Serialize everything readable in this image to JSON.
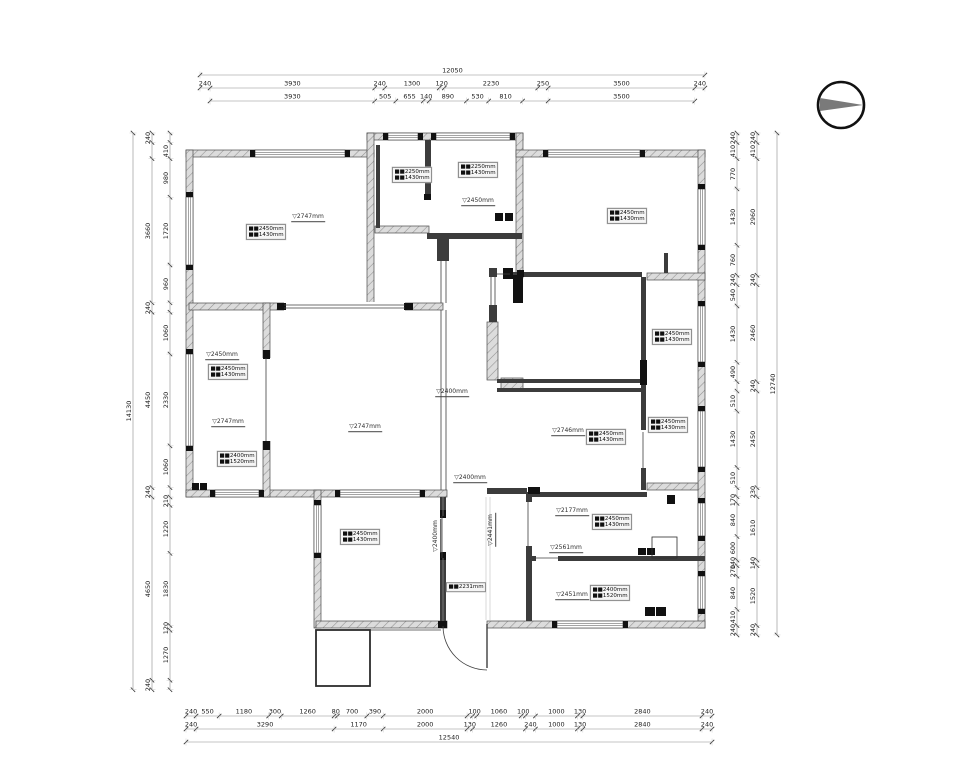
{
  "document": {
    "type": "residential floor plan with dimension chains",
    "north_arrow": "compass-right-pointing"
  },
  "compass": {
    "cx": 841,
    "cy": 105,
    "r": 23,
    "needle_color": "#7a7a7a",
    "ring_color": "#111111"
  },
  "colors": {
    "wall_hatch": "#dcdcdc",
    "wall_stroke": "#4a4a4a",
    "new_wall": "#3c3c3c",
    "dim_line": "#8c8c8c",
    "dim_text": "#222222"
  },
  "dims": [
    {
      "o": "h",
      "x": 200,
      "y": 75,
      "s": 0.0419,
      "segs": [
        {
          "v": 12050
        }
      ]
    },
    {
      "o": "h",
      "x": 200,
      "y": 88,
      "s": 0.0419,
      "segs": [
        240,
        3930,
        240,
        1300,
        120,
        2230,
        250,
        3500,
        240
      ]
    },
    {
      "o": "h",
      "x": 210,
      "y": 101,
      "s": 0.0419,
      "segs": [
        3930,
        505,
        655,
        140,
        890,
        530,
        810,
        {
          "v": 610,
          "l": ""
        },
        3500
      ]
    },
    {
      "o": "v",
      "x": 133,
      "y": 133,
      "s": 0.0394,
      "segs": [
        {
          "v": 14130
        }
      ]
    },
    {
      "o": "v",
      "x": 152,
      "y": 133,
      "s": 0.0394,
      "segs": [
        240,
        {
          "v": 410,
          "l": ""
        },
        3660,
        240,
        4450,
        240,
        4650,
        240
      ]
    },
    {
      "o": "v",
      "x": 170,
      "y": 133,
      "s": 0.0394,
      "segs": [
        {
          "v": 240,
          "l": ""
        },
        410,
        980,
        1720,
        960,
        {
          "v": 240,
          "l": ""
        },
        1060,
        2330,
        1060,
        {
          "v": 240,
          "l": ""
        },
        210,
        1220,
        1830,
        120,
        1270,
        {
          "v": 240,
          "l": ""
        }
      ]
    },
    {
      "o": "v",
      "x": 777,
      "y": 133,
      "s": 0.0394,
      "segs": [
        {
          "v": 12740
        }
      ]
    },
    {
      "o": "v",
      "x": 757,
      "y": 133,
      "s": 0.0394,
      "segs": [
        240,
        410,
        2960,
        240,
        2460,
        240,
        2450,
        230,
        1610,
        140,
        1520,
        240
      ]
    },
    {
      "o": "v",
      "x": 737,
      "y": 133,
      "s": 0.0394,
      "segs": [
        240,
        410,
        770,
        1430,
        760,
        240,
        540,
        1430,
        490,
        {
          "v": 240,
          "l": ""
        },
        510,
        1430,
        510,
        {
          "v": 230,
          "l": ""
        },
        170,
        840,
        600,
        140,
        270,
        840,
        410,
        240
      ]
    },
    {
      "o": "h",
      "x": 186,
      "y": 716,
      "s": 0.04195,
      "segs": [
        240,
        550,
        1180,
        300,
        1260,
        80,
        700,
        390,
        2000,
        {
          "v": 130,
          "l": ""
        },
        100,
        1060,
        100,
        {
          "v": 240,
          "l": ""
        },
        1000,
        130,
        2840,
        240
      ]
    },
    {
      "o": "h",
      "x": 186,
      "y": 729,
      "s": 0.04195,
      "segs": [
        240,
        3290,
        1170,
        2000,
        130,
        1260,
        240,
        1000,
        130,
        2840,
        240
      ]
    },
    {
      "o": "h",
      "x": 186,
      "y": 742,
      "s": 0.04195,
      "segs": [
        {
          "v": 12540
        }
      ]
    }
  ],
  "tags2": [
    {
      "x": 266,
      "y": 232,
      "l1": "■■2450mm",
      "l2": "■■1430mm"
    },
    {
      "x": 412,
      "y": 175,
      "l1": "■■2250mm",
      "l2": "■■1430mm"
    },
    {
      "x": 478,
      "y": 170,
      "l1": "■■2250mm",
      "l2": "■■1430mm"
    },
    {
      "x": 627,
      "y": 216,
      "l1": "■■2450mm",
      "l2": "■■1430mm"
    },
    {
      "x": 228,
      "y": 372,
      "l1": "■■2450mm",
      "l2": "■■1430mm"
    },
    {
      "x": 237,
      "y": 459,
      "l1": "■■2400mm",
      "l2": "■■1520mm"
    },
    {
      "x": 672,
      "y": 337,
      "l1": "■■2450mm",
      "l2": "■■1430mm"
    },
    {
      "x": 668,
      "y": 425,
      "l1": "■■2450mm",
      "l2": "■■1430mm"
    },
    {
      "x": 606,
      "y": 437,
      "l1": "■■2450mm",
      "l2": "■■1430mm"
    },
    {
      "x": 360,
      "y": 537,
      "l1": "■■2450mm",
      "l2": "■■1430mm"
    },
    {
      "x": 612,
      "y": 522,
      "l1": "■■2450mm",
      "l2": "■■1430mm"
    },
    {
      "x": 610,
      "y": 593,
      "l1": "■■2400mm",
      "l2": "■■1520mm"
    }
  ],
  "tags1": [
    {
      "x": 466,
      "y": 587,
      "t": "■■2231mm"
    }
  ],
  "levels": [
    {
      "x": 308,
      "y": 218,
      "t": "▽2747mm"
    },
    {
      "x": 478,
      "y": 202,
      "t": "▽2450mm"
    },
    {
      "x": 222,
      "y": 356,
      "t": "▽2450mm"
    },
    {
      "x": 228,
      "y": 423,
      "t": "▽2747mm"
    },
    {
      "x": 365,
      "y": 428,
      "t": "▽2747mm"
    },
    {
      "x": 568,
      "y": 432,
      "t": "▽2746mm"
    },
    {
      "x": 452,
      "y": 393,
      "t": "▽2400mm"
    },
    {
      "x": 470,
      "y": 479,
      "t": "▽2400mm"
    },
    {
      "x": 437,
      "y": 536,
      "t": "▽2400mm",
      "r": 1
    },
    {
      "x": 492,
      "y": 530,
      "t": "▽2441mm",
      "r": 1
    },
    {
      "x": 572,
      "y": 512,
      "t": "▽2177mm"
    },
    {
      "x": 566,
      "y": 549,
      "t": "▽2561mm"
    },
    {
      "x": 572,
      "y": 596,
      "t": "▽2451mm"
    }
  ],
  "plan": {
    "walls": [
      [
        186,
        150,
        188,
        7
      ],
      [
        367,
        133,
        156,
        7
      ],
      [
        516,
        133,
        7,
        145
      ],
      [
        367,
        133,
        7,
        170
      ],
      [
        516,
        150,
        189,
        7
      ],
      [
        698,
        150,
        7,
        478
      ],
      [
        186,
        150,
        7,
        347
      ],
      [
        186,
        490,
        261,
        7
      ],
      [
        314,
        490,
        7,
        138
      ],
      [
        316,
        621,
        131,
        7
      ],
      [
        487,
        621,
        218,
        7
      ],
      [
        189,
        303,
        254,
        7
      ],
      [
        263,
        303,
        7,
        194
      ],
      [
        375,
        226,
        54,
        7
      ],
      [
        647,
        273,
        58,
        7
      ],
      [
        647,
        483,
        51,
        7
      ],
      [
        487,
        322,
        11,
        58
      ],
      [
        501,
        378,
        22,
        13
      ]
    ],
    "nwalls": [
      [
        425,
        140,
        6,
        60
      ],
      [
        427,
        233,
        95,
        6
      ],
      [
        437,
        239,
        12,
        22
      ],
      [
        376,
        145,
        4,
        83
      ],
      [
        510,
        272,
        132,
        5
      ],
      [
        641,
        277,
        5,
        153
      ],
      [
        641,
        468,
        5,
        22
      ],
      [
        497,
        379,
        145,
        4
      ],
      [
        497,
        388,
        145,
        4
      ],
      [
        526,
        492,
        6,
        10
      ],
      [
        526,
        546,
        6,
        75
      ],
      [
        530,
        492,
        117,
        5
      ],
      [
        526,
        556,
        10,
        5
      ],
      [
        558,
        556,
        147,
        5
      ],
      [
        440,
        497,
        6,
        19
      ],
      [
        440,
        558,
        6,
        63
      ],
      [
        487,
        488,
        40,
        6
      ],
      [
        489,
        268,
        8,
        9
      ],
      [
        489,
        305,
        8,
        17
      ],
      [
        664,
        253,
        4,
        20
      ]
    ],
    "gaps": [
      [
        262,
        358,
        9,
        83
      ],
      [
        284,
        302,
        121,
        9
      ]
    ],
    "windows": [
      [
        255,
        150,
        90,
        "h"
      ],
      [
        388,
        133,
        30,
        "h"
      ],
      [
        436,
        133,
        74,
        "h"
      ],
      [
        548,
        150,
        92,
        "h"
      ],
      [
        698,
        189,
        56,
        "v"
      ],
      [
        698,
        306,
        56,
        "v"
      ],
      [
        698,
        411,
        56,
        "v"
      ],
      [
        698,
        503,
        33,
        "v"
      ],
      [
        698,
        576,
        33,
        "v"
      ],
      [
        557,
        621,
        66,
        "h"
      ],
      [
        186,
        197,
        68,
        "v"
      ],
      [
        186,
        354,
        92,
        "v"
      ],
      [
        215,
        490,
        44,
        "h"
      ],
      [
        340,
        490,
        80,
        "h"
      ],
      [
        314,
        505,
        48,
        "v"
      ]
    ],
    "solids": [
      [
        503,
        268,
        10,
        11
      ],
      [
        513,
        275,
        10,
        28
      ],
      [
        640,
        360,
        7,
        25
      ],
      [
        495,
        213,
        8,
        8
      ],
      [
        505,
        213,
        8,
        8
      ],
      [
        638,
        548,
        8,
        7
      ],
      [
        647,
        548,
        8,
        7
      ],
      [
        645,
        607,
        10,
        9
      ],
      [
        656,
        607,
        10,
        9
      ],
      [
        192,
        483,
        7,
        7
      ],
      [
        200,
        483,
        7,
        7
      ],
      [
        438,
        621,
        9,
        7
      ],
      [
        440,
        510,
        6,
        8
      ],
      [
        440,
        552,
        6,
        8
      ],
      [
        263,
        350,
        7,
        9
      ],
      [
        263,
        441,
        7,
        9
      ],
      [
        277,
        303,
        9,
        7
      ],
      [
        404,
        303,
        9,
        7
      ],
      [
        517,
        270,
        7,
        7
      ],
      [
        528,
        487,
        12,
        7
      ],
      [
        424,
        194,
        7,
        6
      ],
      [
        667,
        495,
        8,
        9
      ]
    ],
    "lines": [
      [
        266,
        358,
        266,
        441
      ],
      [
        284,
        305,
        405,
        305
      ],
      [
        284,
        308,
        405,
        308
      ],
      [
        441,
        261,
        441,
        303
      ],
      [
        446,
        261,
        446,
        303
      ],
      [
        441,
        310,
        441,
        490
      ],
      [
        446,
        310,
        446,
        490
      ],
      [
        442,
        516,
        442,
        558
      ],
      [
        497,
        274,
        510,
        274
      ],
      [
        536,
        558,
        558,
        558
      ],
      [
        528,
        502,
        528,
        546
      ],
      [
        491,
        277,
        491,
        305
      ],
      [
        495,
        277,
        495,
        305
      ],
      [
        643,
        432,
        643,
        468
      ],
      [
        370,
        630,
        441,
        630
      ],
      [
        487,
        624,
        487,
        668,
        1.4
      ]
    ],
    "lite": [
      [
        486,
        497,
        486,
        620
      ],
      [
        490,
        497,
        490,
        620
      ],
      [
        443,
        497,
        443,
        516
      ],
      [
        443,
        558,
        443,
        621
      ]
    ],
    "thinrects": [
      [
        316,
        630,
        54,
        56,
        1.8
      ],
      [
        652,
        537,
        25,
        21,
        0.8
      ]
    ],
    "arcs": [
      "M 443 626 A 44 44 0 0 0 487 670"
    ]
  }
}
